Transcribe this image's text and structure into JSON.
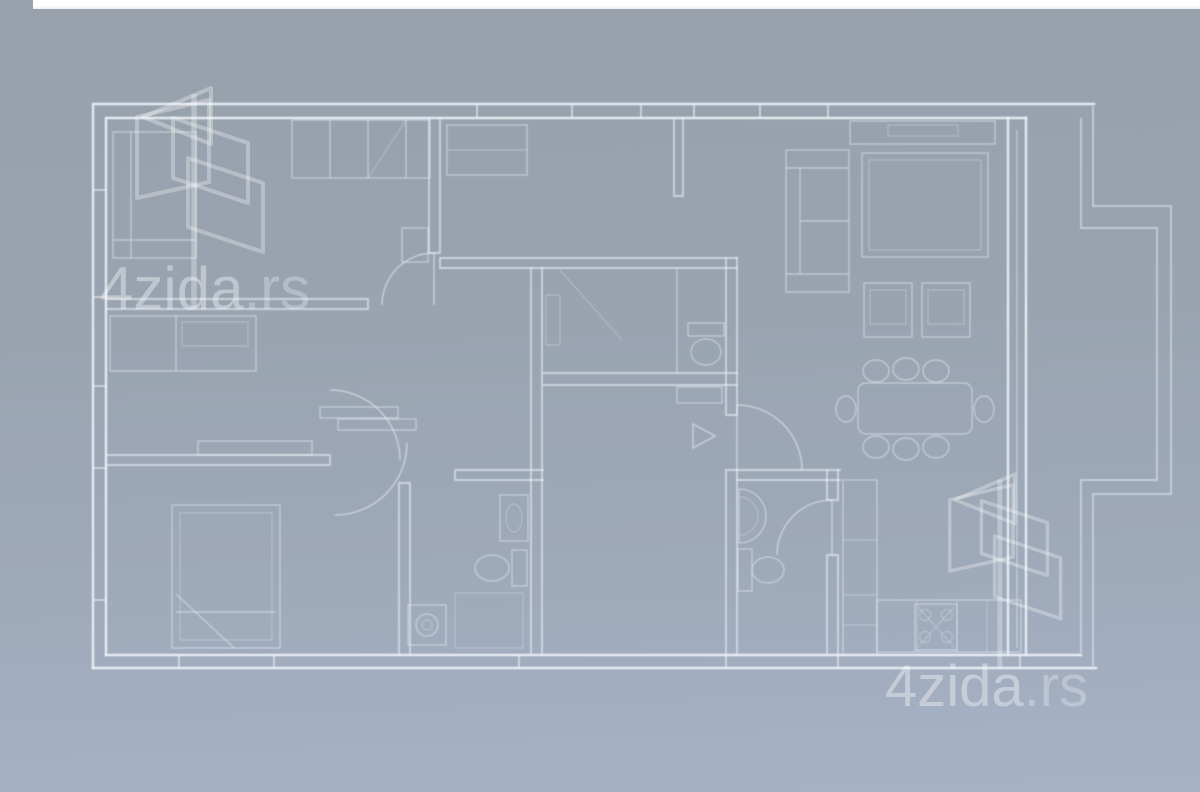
{
  "image": {
    "kind": "real-estate floor plan (blueprint, white lines on gray-blue photo)",
    "rooms_labeled": false
  },
  "topbar": {
    "color": "#fdfdfe"
  },
  "watermark": {
    "brand": "4zida",
    "tld": ".rs",
    "full": "4zida.rs",
    "count": 2,
    "positions": [
      "left-middle",
      "bottom-right"
    ],
    "color": "#ffffff"
  },
  "colors": {
    "background_top": "#98a1ac",
    "background_bottom": "#a6b2c5",
    "line": "#eef3fa",
    "topbar": "#fdfdfe"
  },
  "floorplan": {
    "style": "white blueprint linework",
    "depicts": [
      "outer-walls-with-windows",
      "balcony-stepped-outline-right",
      "bedroom-top-left-with-wardrobe-and-bed",
      "bedroom-middle-left-with-dresser",
      "bedroom-bottom-left-with-double-bed",
      "hallway",
      "wc-with-toilet",
      "bathroom-with-sink-and-toilet",
      "bathroom-with-washing-machine",
      "living-room-with-sofa-rug-tv-stand-armchairs",
      "dining-table-with-eight-chairs",
      "kitchen-counter-with-stove",
      "entry-arrow",
      "door-swing-arcs"
    ]
  }
}
